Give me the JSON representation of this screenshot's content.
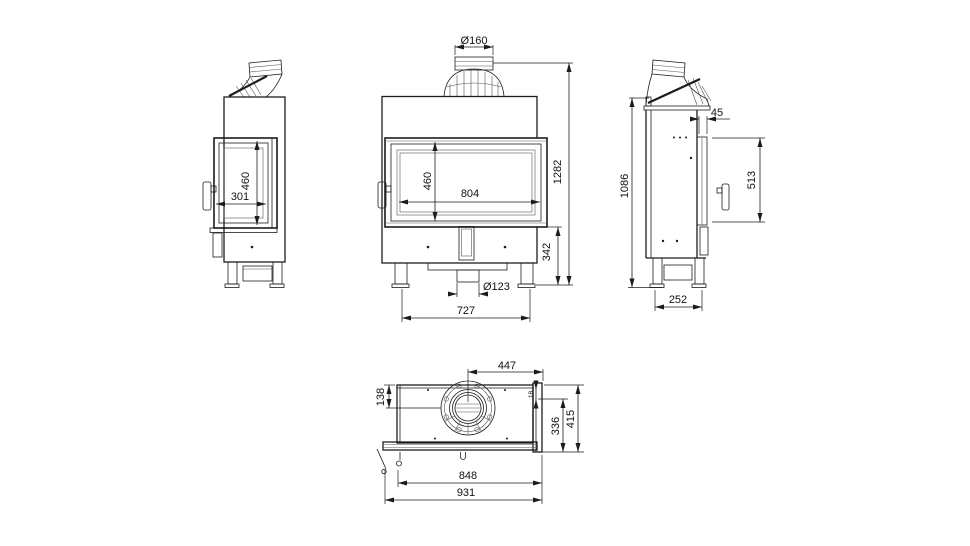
{
  "page": {
    "background": "#ffffff",
    "line_color": "#1c1c1c",
    "text_color": "#111111",
    "drawing_type": "fireplace insert technical drawing, four orthographic views"
  },
  "views": {
    "side_left": {
      "label": "left side view",
      "door_width": "301",
      "door_height": "460"
    },
    "front": {
      "label": "front view",
      "flue_diameter": "Ø160",
      "glass_width": "804",
      "glass_height": "460",
      "overall_height": "1282",
      "base_height": "342",
      "inlet_diameter": "Ø123",
      "leg_spacing": "727"
    },
    "side_right": {
      "label": "right side view",
      "overall_height": "1086",
      "frame_offset": "45",
      "door_height": "513",
      "base_depth": "252"
    },
    "top": {
      "label": "top view",
      "flue_to_right_edge": "447",
      "back_to_flue_center": "138",
      "panel_gap": "18",
      "inner_depth": "336",
      "overall_depth": "415",
      "glass_width": "848",
      "overall_width": "931"
    }
  }
}
